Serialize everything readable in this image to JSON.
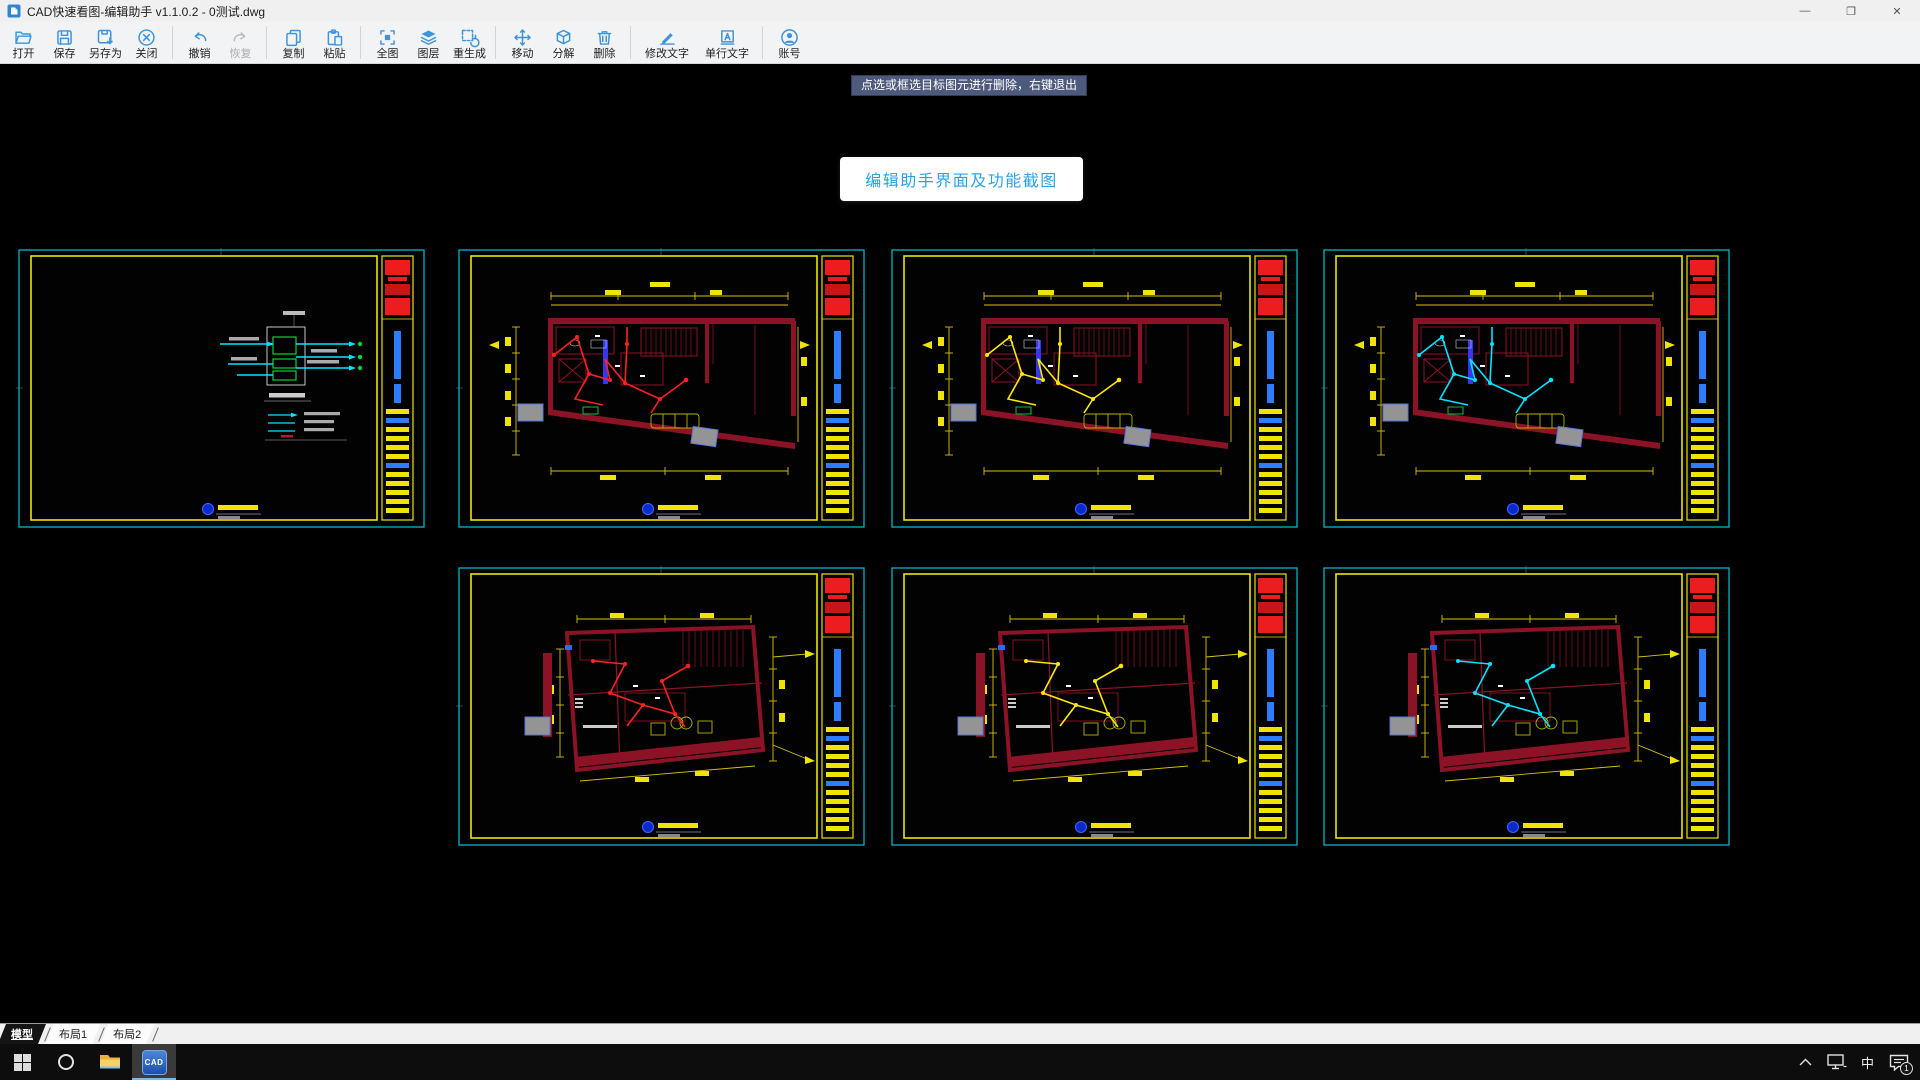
{
  "window": {
    "title": "CAD快速看图-编辑助手 v1.1.0.2 - 0测试.dwg",
    "controls": {
      "minimize": "—",
      "maximize": "❐",
      "close": "✕"
    }
  },
  "toolbar": {
    "groups": [
      {
        "items": [
          {
            "id": "open",
            "label": "打开",
            "icon": "folder-open-icon"
          },
          {
            "id": "save",
            "label": "保存",
            "icon": "save-icon"
          },
          {
            "id": "save-as",
            "label": "另存为",
            "icon": "save-as-icon"
          },
          {
            "id": "close-file",
            "label": "关闭",
            "icon": "close-circle-icon"
          }
        ]
      },
      {
        "items": [
          {
            "id": "undo",
            "label": "撤销",
            "icon": "undo-icon"
          },
          {
            "id": "redo",
            "label": "恢复",
            "icon": "redo-icon",
            "disabled": true
          }
        ]
      },
      {
        "items": [
          {
            "id": "copy",
            "label": "复制",
            "icon": "copy-icon"
          },
          {
            "id": "paste",
            "label": "粘贴",
            "icon": "paste-icon"
          }
        ]
      },
      {
        "items": [
          {
            "id": "full-view",
            "label": "全图",
            "icon": "full-extent-icon"
          },
          {
            "id": "layers",
            "label": "图层",
            "icon": "layers-icon"
          },
          {
            "id": "regen",
            "label": "重生成",
            "icon": "regen-icon"
          }
        ]
      },
      {
        "items": [
          {
            "id": "move",
            "label": "移动",
            "icon": "move-icon"
          },
          {
            "id": "explode",
            "label": "分解",
            "icon": "explode-icon"
          },
          {
            "id": "delete",
            "label": "删除",
            "icon": "trash-icon"
          }
        ]
      },
      {
        "items": [
          {
            "id": "edit-text",
            "label": "修改文字",
            "icon": "edit-text-icon",
            "wide": true
          },
          {
            "id": "single-text",
            "label": "单行文字",
            "icon": "single-text-icon",
            "wide": true
          }
        ]
      },
      {
        "items": [
          {
            "id": "account",
            "label": "账号",
            "icon": "account-icon"
          }
        ]
      }
    ]
  },
  "tooltip": {
    "text": "点选或框选目标图元进行删除，右键退出"
  },
  "overlay_button": {
    "label": "编辑助手界面及功能截图"
  },
  "sheets": [
    {
      "variant": "schematic",
      "wire": "#00e5ff",
      "row": 1,
      "col": 1
    },
    {
      "variant": "planA",
      "wire": "#ff2020",
      "row": 1,
      "col": 2
    },
    {
      "variant": "planA",
      "wire": "#ffe800",
      "row": 1,
      "col": 3
    },
    {
      "variant": "planA",
      "wire": "#00e5ff",
      "row": 1,
      "col": 4
    },
    {
      "variant": "planB",
      "wire": "#ff2020",
      "row": 2,
      "col": 2
    },
    {
      "variant": "planB",
      "wire": "#ffe800",
      "row": 2,
      "col": 3
    },
    {
      "variant": "planB",
      "wire": "#00e5ff",
      "row": 2,
      "col": 4
    }
  ],
  "layout_tabs": [
    {
      "label": "模型",
      "active": true
    },
    {
      "label": "布局1",
      "active": false
    },
    {
      "label": "布局2",
      "active": false
    }
  ],
  "taskbar": {
    "cad_app_label": "CAD",
    "tray": {
      "ime": "中",
      "badge": "1"
    }
  },
  "colors": {
    "sheet_border_cyan": "#00b6c4",
    "sheet_border_yellow": "#efe400",
    "stamp_red": "#ee1d1d",
    "titleblock_blue": "#2e7dff",
    "plan_wall_maroon": "#8c1226",
    "dim_yellow": "#d6c300",
    "accent_blue": "#2aa3e6"
  }
}
